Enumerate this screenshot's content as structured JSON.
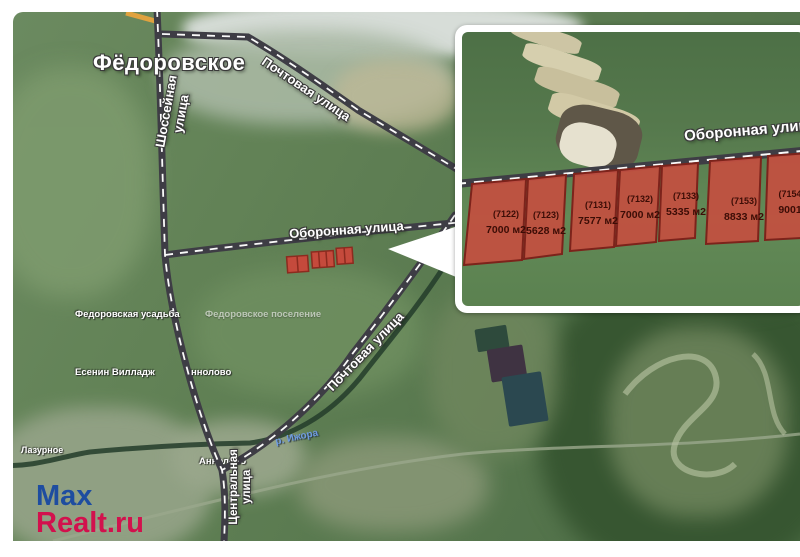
{
  "watermark": {
    "line1": "Max",
    "line2": "Realt.ru"
  },
  "main_map": {
    "town": "Фёдоровское",
    "street_shosseynaya": "Шоссейная улица",
    "street_pochtovaya_top": "Почтовая улица",
    "street_oboronnaya": "Оборонная улица",
    "street_pochtovaya_bottom": "Почтовая улица",
    "street_tsentralnaya": "Центральная улица",
    "place_usadba": "Федоровская усадьба",
    "place_poselenie": "Федоровское поселение",
    "place_yesenin": "Есенин Вилладж",
    "place_annolovo_partial": "ннолово",
    "place_annolovo": "Аннолово",
    "place_lazurnoye": "Лазурное",
    "river_label": "р. Ижора"
  },
  "inset": {
    "street": "Оборонная улица",
    "plots": [
      {
        "id": "(7122)",
        "area": "7000 м2"
      },
      {
        "id": "(7123)",
        "area": "5628 м2"
      },
      {
        "id": "(7131)",
        "area": "7577 м2"
      },
      {
        "id": "(7132)",
        "area": "7000 м2"
      },
      {
        "id": "(7133)",
        "area": "5335 м2"
      },
      {
        "id": "(7153)",
        "area": "8833 м2"
      },
      {
        "id": "(7154",
        "area": "9001"
      }
    ]
  },
  "colors": {
    "plot_fill": "#c74e3f",
    "plot_border": "#7c231b",
    "road": "#3e3d45",
    "logo_blue": "#1e4da0",
    "logo_red": "#d2114d"
  }
}
